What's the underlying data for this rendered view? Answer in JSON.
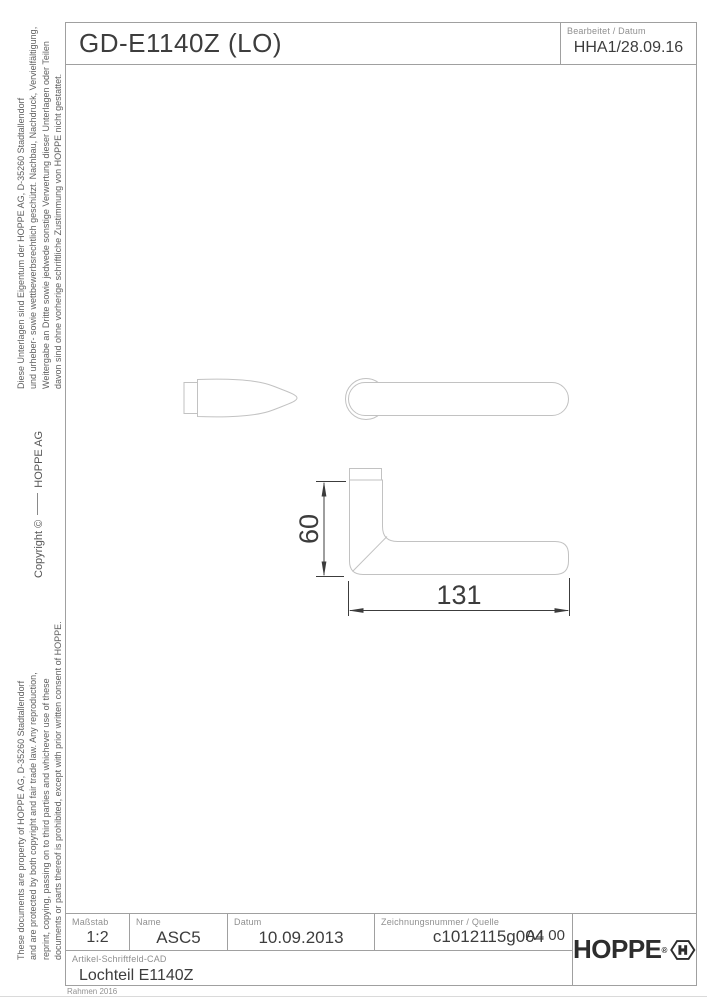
{
  "header": {
    "title": "GD-E1140Z (LO)",
    "edited_label": "Bearbeitet  / Datum",
    "edited_value": "HHA1/28.09.16"
  },
  "side_notices": {
    "german": [
      "Diese Unterlagen sind Eigentum der  HOPPE AG, D-35260 Stadtallendorf",
      "und urheber- sowie wettbewerbsrechtlich geschützt. Nachbau, Nachdruck, Vervielfältigung,",
      "Weitergabe an Dritte sowie jedwede sonstige Verwertung dieser Unterlagen oder Teilen",
      "davon sind ohne vorherige schriftliche Zustimmung von HOPPE nicht gestattet."
    ],
    "copyright_left": "Copyright ©",
    "copyright_right": "HOPPE AG",
    "english": [
      "These documents are property of HOPPE AG, D-35260 Stadtallendorf",
      "and are protected by both copyright and fair trade law. Any reproduction,",
      "reprint, copying, passing on to third parties and whichever use of these",
      "documents or parts thereof is prohibited, except with prior written consent of HOPPE."
    ]
  },
  "drawing": {
    "dim_height": "60",
    "dim_length": "131"
  },
  "title_block": {
    "scale_label": "Maßstab",
    "scale_value": "1:2",
    "name_label": "Name",
    "name_value": "ASC5",
    "date_label": "Datum",
    "date_value": "10.09.2013",
    "number_label": "Zeichnungsnummer / Quelle",
    "number_value": "c1012115g004",
    "format_value": "A4 00",
    "article_label": "Artikel-Schriftfeld-CAD",
    "article_value": "Lochteil E1140Z",
    "brand": "HOPPE",
    "brand_r": "®"
  },
  "footer": {
    "frame_note": "Rahmen 2016"
  }
}
